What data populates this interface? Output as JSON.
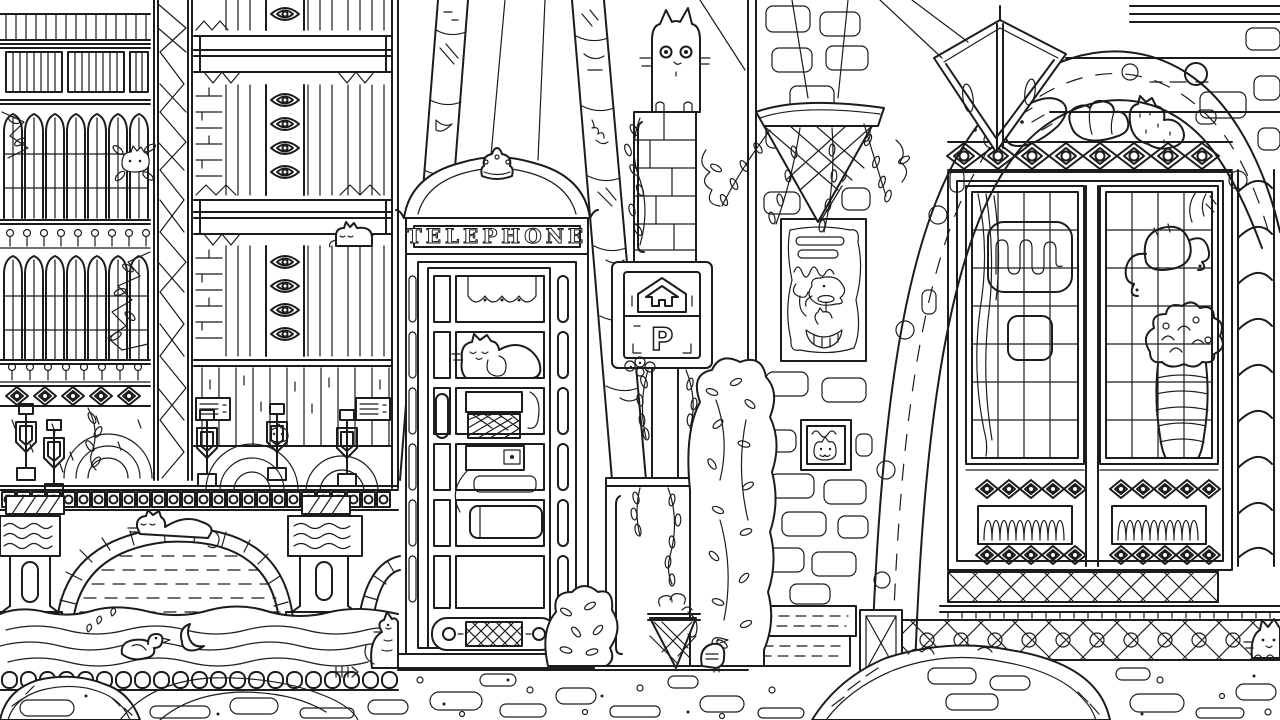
{
  "scene": {
    "kind": "coloring-book line-art illustration",
    "description": "Black-and-white pen illustration of a city street: ornate apartment facade, canal bridge, British telephone box, parking sign, brick wall with poster, bakery shopfront, and cats hidden throughout",
    "line_color": "#1c1c1c",
    "background_color": "#ffffff"
  },
  "texts": {
    "telephone_sign": "TELEPHONE",
    "parking_letter": "P"
  },
  "inventory": [
    "gothic-apartment-facade",
    "crystal-pattern-pillar",
    "diamond-chain-columns",
    "stone-canal-bridge",
    "bridge-cat",
    "canal-water-with-duck-and-fish",
    "ornate-bridge-pillars",
    "telephone-box-with-crown",
    "cat-using-payphone",
    "patterned-circus-poles",
    "light-rays",
    "standing-cat",
    "parking-sign-house-arrow",
    "stone-column-with-vine",
    "planter-pedestal",
    "bushes",
    "wire-litter-basket",
    "pigeon",
    "brick-wall-poster",
    "cat-relief-carving",
    "stone-steps",
    "wooden-crate",
    "hanging-flower-basket",
    "bakery-stone-arch",
    "diamond-lantern",
    "baguette-croissant-cat-pastry",
    "mullioned-shop-windows",
    "croissant-in-window",
    "flower-bouquet-in-vase",
    "twisted-rope-column",
    "lattice-base-wall",
    "cobblestone-street",
    "street-mounds",
    "corner-cats",
    "fish-bones"
  ]
}
